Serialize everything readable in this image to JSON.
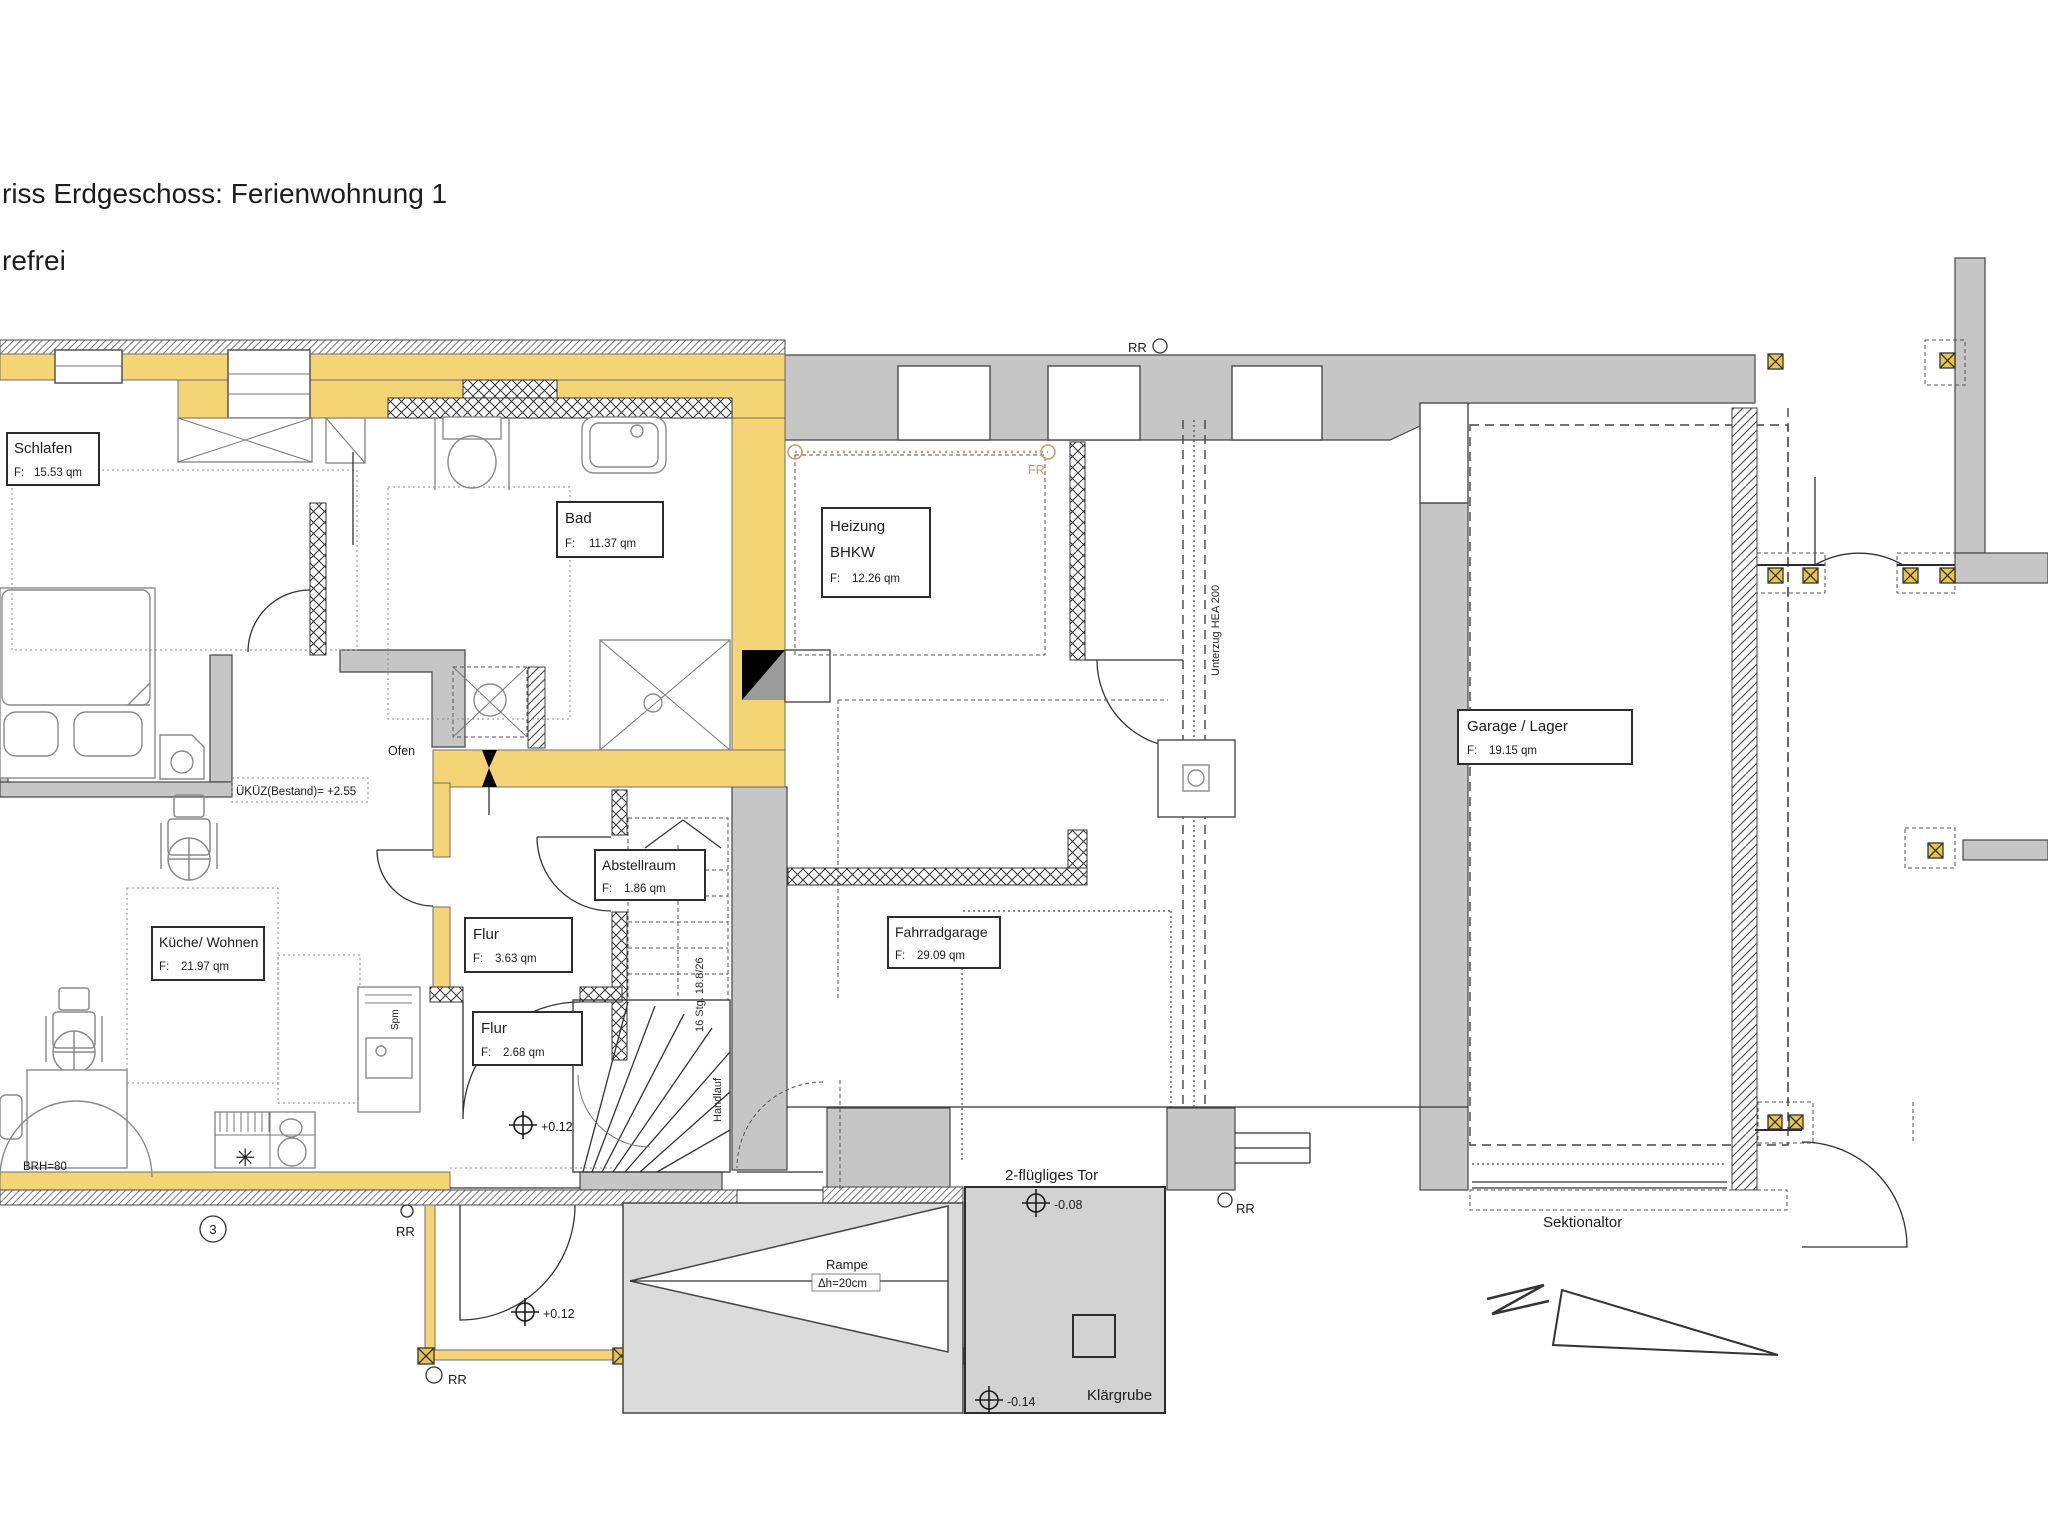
{
  "header": {
    "title": "riss Erdgeschoss: Ferienwohnung 1",
    "subtitle": "refrei"
  },
  "labels": {
    "area_prefix": "F:"
  },
  "rooms": [
    {
      "name": "Schlafen",
      "area": "15.53 qm"
    },
    {
      "name": "Bad",
      "area": "11.37 qm"
    },
    {
      "name": "Heizung",
      "name2": "BHKW",
      "area": "12.26 qm"
    },
    {
      "name": "Garage / Lager",
      "area": "19.15 qm"
    },
    {
      "name": "Küche/ Wohnen",
      "area": "21.97 qm"
    },
    {
      "name": "Abstellraum",
      "area": "1.86 qm"
    },
    {
      "name": "Flur",
      "area": "3.63 qm"
    },
    {
      "name": "Flur",
      "area": "2.68 qm"
    },
    {
      "name": "Fahrradgarage",
      "area": "29.09 qm"
    }
  ],
  "annotations": {
    "ukuz": "ÜKÜZ(Bestand)= +2.55",
    "ofen": "Ofen",
    "brh": "BRH=80",
    "rr": "RR",
    "fr": "FR",
    "unterzug": "Unterzug HEA 200",
    "stair_count": "16 Stg. 18.8/26",
    "handlauf": "Handlauf",
    "tor": "2-flügliges Tor",
    "rampe": "Rampe",
    "rampe_height": "Δh=20cm",
    "klaergrube": "Klärgrube",
    "sektionaltor": "Sektionaltor",
    "spuelmaschine": "Spm",
    "grid_label": "3"
  },
  "levels": {
    "entry": "+0.12",
    "tor": "-0.08",
    "klaergrube": "-0.14"
  },
  "colors": {
    "apartment_wall_yellow": "#F5D476",
    "wall_gray": "#C6C6C6",
    "ramp_gray": "#DBDBDB",
    "fr_line_tan": "#C69C6D",
    "post_yellow": "#E9C44B"
  }
}
